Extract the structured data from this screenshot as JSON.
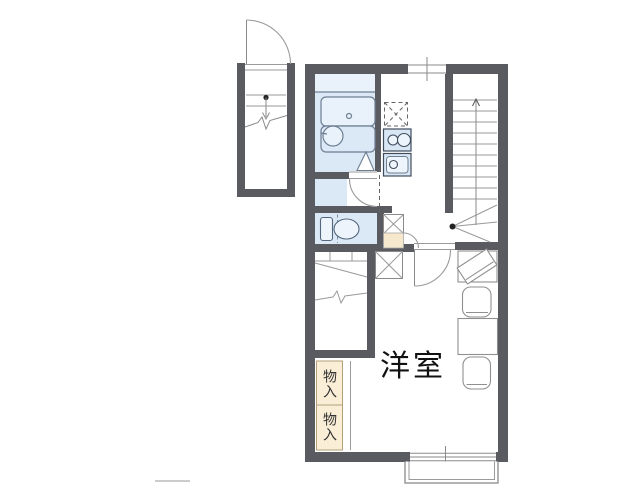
{
  "plan": {
    "room_label": "洋室",
    "storage_labels": [
      "物入",
      "物入"
    ]
  },
  "colors": {
    "wall": "#5a5a61",
    "room_fill": "#dbe8f6",
    "room_fill_light": "#e9f1fa",
    "fixture_fill": "#d9e7f5",
    "accent_beige": "#f6e8cd",
    "storage_beige": "#faeed6",
    "fixture_line": "#3f4c5c",
    "bath_line": "#6e7f92",
    "furniture_line": "#8f8f8f",
    "background": "#ffffff"
  },
  "fixtures": [
    "entrance-door",
    "porch-steps",
    "bathtub",
    "wash-basin",
    "bath-folding-door",
    "refrigerator-space",
    "gas-stove",
    "kitchen-sink",
    "washroom-door",
    "toilet",
    "washing-machine-space",
    "toilet-door",
    "staircase",
    "stair-direction-arrow",
    "closet",
    "storage-upper",
    "storage-lower",
    "room-door",
    "tv-board",
    "chair",
    "dining-table",
    "chair",
    "window-top",
    "window-bottom",
    "balcony",
    "scale-bar"
  ]
}
